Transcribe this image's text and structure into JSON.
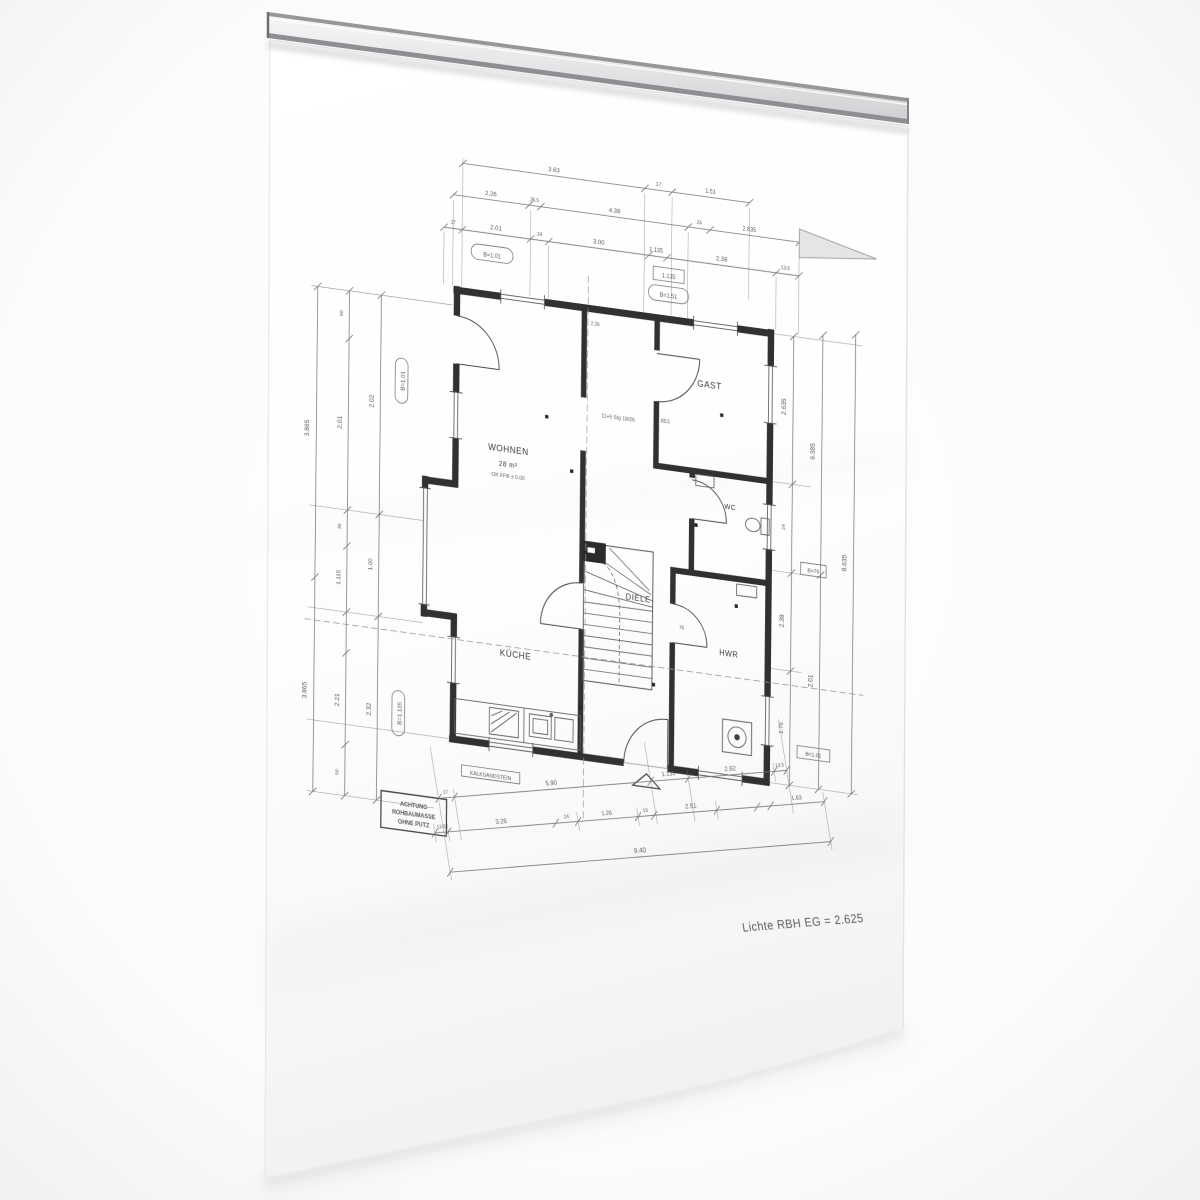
{
  "labels": {
    "rooms": {
      "wohnen": "WOHNEN",
      "wohnen_area": "28 m²",
      "wohnen_level": "OK FFB ± 0.00",
      "gast": "GAST",
      "kueche": "KÜCHE",
      "diele": "DIELE",
      "hwr": "HWR",
      "wc": "WC"
    },
    "stair_note": "11+6 Stg 18/26",
    "material_note": "KALKSANDSTEIN",
    "stamp": [
      "ACHTUNG",
      "ROHBAUMASSE",
      "OHNE PUTZ"
    ],
    "height_note": "Lichte RBH EG = 2.625"
  },
  "plan_small": [
    "2.26",
    "88.5",
    "76"
  ],
  "dims": {
    "top": {
      "row1": [
        "3.63",
        "17",
        "1.51"
      ],
      "row2": [
        "2.26",
        "36.5",
        "4.38",
        "24",
        "2.635"
      ],
      "row3": [
        "17",
        "2.01",
        "24",
        "3.00",
        "1.135",
        "2.38",
        "13.5"
      ],
      "oval1": "B=1.01",
      "box1": "1.135",
      "oval2": "B=1.51"
    },
    "left": {
      "outer": [
        "3.865",
        "3.865"
      ],
      "mid": [
        "50",
        "2.01",
        "36",
        "1.115",
        "2.21",
        "50"
      ],
      "inner": [
        "2.02",
        "1.00",
        "2.32"
      ],
      "oval1": "B=1.01",
      "oval2": "B=1.135"
    },
    "right": {
      "inner": [
        "2.635",
        "24",
        "2.38",
        "1.76"
      ],
      "mid": [
        "6.385",
        "2.01"
      ],
      "outer": [
        "8.635"
      ],
      "box1": "B=76",
      "box2": "B=1.01"
    },
    "bottom": {
      "row1": [
        "17",
        "5.90",
        "1.135",
        "2.62",
        "13.5"
      ],
      "row2": [
        "13.5",
        "3.26",
        "24",
        "1.26",
        "13",
        "2.51",
        "1.63"
      ],
      "total": "9.40"
    }
  },
  "colors": {
    "paper": "#ffffff",
    "rail_face": "#e7e7e9",
    "wall_line": "#222222",
    "dim_line": "#6a6a6a",
    "background": "#f7f7f8"
  }
}
